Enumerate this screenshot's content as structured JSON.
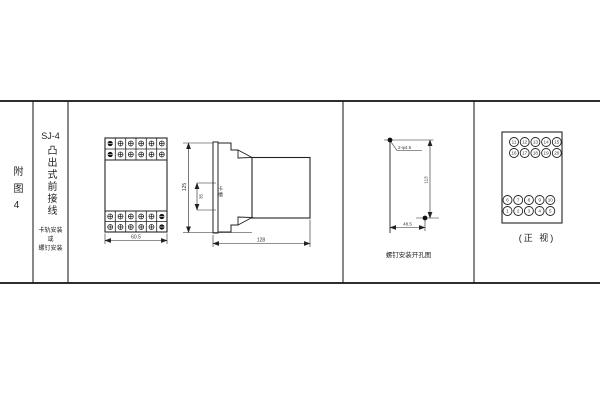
{
  "title_block": {
    "figure_label": "附图4",
    "model": "SJ-4",
    "type_label": "凸出式前接线",
    "mount_text": "卡轨安装\n或\n螺钉安装"
  },
  "front_view": {
    "width_dim": "60.5"
  },
  "side_view": {
    "height_dim": "125",
    "slot_dim": "35",
    "slot_label": "卡槽",
    "depth_dim": "128"
  },
  "drill_view": {
    "holes_label": "2-φ4.5",
    "height_dim": "113",
    "width_dim": "48.5",
    "caption": "螺钉安装开孔图"
  },
  "terminal_view": {
    "caption": "(正 视)",
    "top_rows": [
      [
        "11",
        "12",
        "13",
        "14",
        "15"
      ],
      [
        "16",
        "17",
        "18",
        "19",
        "20"
      ]
    ],
    "bottom_rows": [
      [
        "6",
        "7",
        "8",
        "9",
        "10"
      ],
      [
        "1",
        "2",
        "3",
        "4",
        "5"
      ]
    ]
  }
}
